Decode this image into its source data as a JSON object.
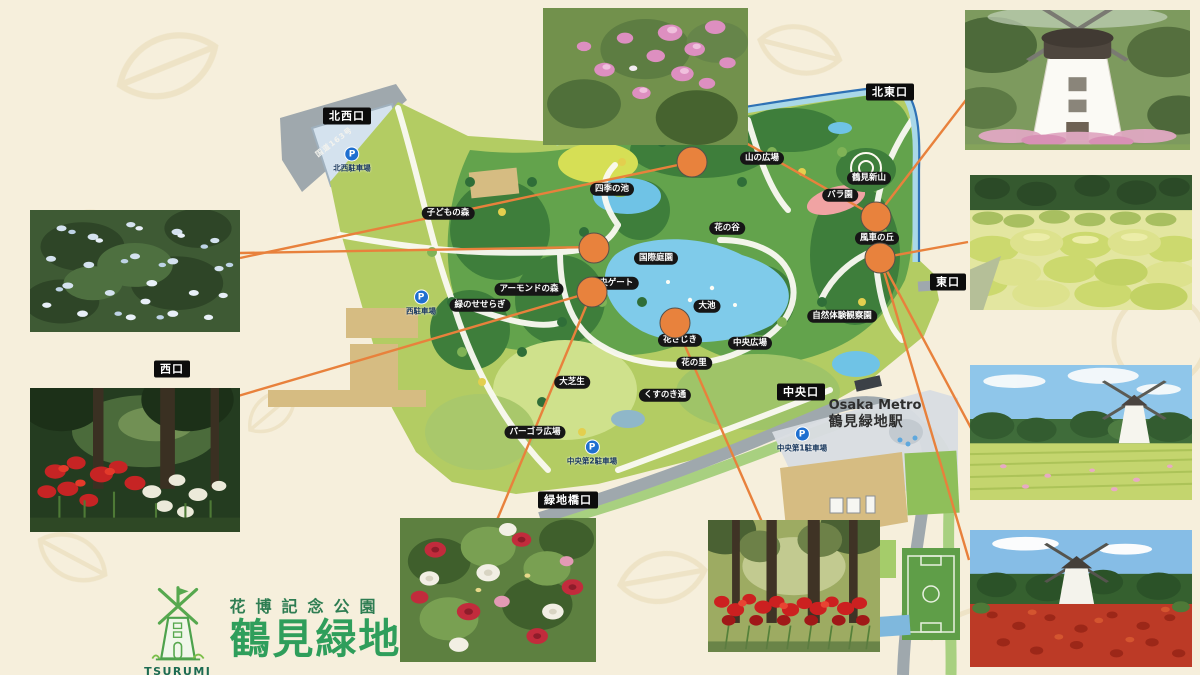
{
  "colors": {
    "background": "#f6efdc",
    "accent_orange": "#e8823d",
    "connector_orange": "#e8813c",
    "label_bg": "#141414",
    "park_green": "#b3cc63",
    "forest_green": "#3e7e3b",
    "pond_blue": "#7fcbea",
    "logo_green": "#2f9e5b",
    "parking_blue": "#1f6fd0"
  },
  "logo": {
    "park_type": "花博記念公園",
    "park_name": "鶴見緑地",
    "en_line1": "TSURUMI",
    "en_line2": "RYOKUCHI"
  },
  "station": {
    "brand": "Osaka Metro",
    "name": "鶴見緑地駅"
  },
  "map": {
    "road_label": "国道163号",
    "entrances": [
      {
        "id": "northwest",
        "label": "北西口",
        "x": 347,
        "y": 116
      },
      {
        "id": "northeast",
        "label": "北東口",
        "x": 890,
        "y": 92
      },
      {
        "id": "east",
        "label": "東口",
        "x": 948,
        "y": 282
      },
      {
        "id": "west",
        "label": "西口",
        "x": 172,
        "y": 369
      },
      {
        "id": "central",
        "label": "中央口",
        "x": 801,
        "y": 392
      },
      {
        "id": "ryokuchibashi",
        "label": "緑地橋口",
        "x": 568,
        "y": 500
      }
    ],
    "places": [
      {
        "label": "子どもの森",
        "x": 448,
        "y": 213
      },
      {
        "label": "アーモンドの森",
        "x": 529,
        "y": 289
      },
      {
        "label": "緑のせせらぎ",
        "x": 480,
        "y": 305
      },
      {
        "label": "四季の池",
        "x": 612,
        "y": 189
      },
      {
        "label": "山の広場",
        "x": 762,
        "y": 158
      },
      {
        "label": "花の谷",
        "x": 727,
        "y": 228
      },
      {
        "label": "国際庭園",
        "x": 656,
        "y": 258
      },
      {
        "label": "中央ゲート",
        "x": 612,
        "y": 283
      },
      {
        "label": "大池",
        "x": 707,
        "y": 306
      },
      {
        "label": "花さじき",
        "x": 680,
        "y": 340
      },
      {
        "label": "中央広場",
        "x": 750,
        "y": 343
      },
      {
        "label": "花の里",
        "x": 694,
        "y": 363
      },
      {
        "label": "大芝生",
        "x": 572,
        "y": 382
      },
      {
        "label": "くすのき通",
        "x": 665,
        "y": 395
      },
      {
        "label": "パーゴラ広場",
        "x": 535,
        "y": 432
      },
      {
        "label": "鶴見新山",
        "x": 869,
        "y": 178
      },
      {
        "label": "バラ園",
        "x": 840,
        "y": 195
      },
      {
        "label": "風車の丘",
        "x": 877,
        "y": 238
      },
      {
        "label": "自然体験観察園",
        "x": 842,
        "y": 316
      }
    ],
    "parkings": [
      {
        "label": "北西駐車場",
        "x": 352,
        "y": 160
      },
      {
        "label": "西駐車場",
        "x": 421,
        "y": 303
      },
      {
        "label": "中央第2駐車場",
        "x": 592,
        "y": 453
      },
      {
        "label": "中央第1駐車場",
        "x": 802,
        "y": 440
      }
    ],
    "markers": [
      {
        "x": 692,
        "y": 162
      },
      {
        "x": 594,
        "y": 248
      },
      {
        "x": 592,
        "y": 292
      },
      {
        "x": 675,
        "y": 323
      },
      {
        "x": 876,
        "y": 217
      },
      {
        "x": 880,
        "y": 258
      }
    ],
    "connectors": [
      {
        "x1": 240,
        "y1": 253,
        "x2": 596,
        "y2": 247
      },
      {
        "x1": 240,
        "y1": 258,
        "x2": 692,
        "y2": 162
      },
      {
        "x1": 238,
        "y1": 396,
        "x2": 592,
        "y2": 292
      },
      {
        "x1": 592,
        "y1": 292,
        "x2": 497,
        "y2": 520
      },
      {
        "x1": 675,
        "y1": 323,
        "x2": 762,
        "y2": 522
      },
      {
        "x1": 746,
        "y1": 143,
        "x2": 876,
        "y2": 217
      },
      {
        "x1": 966,
        "y1": 100,
        "x2": 876,
        "y2": 217
      },
      {
        "x1": 968,
        "y1": 242,
        "x2": 880,
        "y2": 258
      },
      {
        "x1": 880,
        "y1": 258,
        "x2": 971,
        "y2": 428
      },
      {
        "x1": 880,
        "y1": 258,
        "x2": 969,
        "y2": 560
      }
    ]
  },
  "photos": [
    {
      "id": "mukuge",
      "desc": "pink flowering shrub"
    },
    {
      "id": "windmill-closeup",
      "desc": "windmill close-up with pink grasses"
    },
    {
      "id": "kochia",
      "desc": "green kochia mounds garden"
    },
    {
      "id": "windmill-field",
      "desc": "windmill beside green flower field"
    },
    {
      "id": "windmill-red-field",
      "desc": "windmill above red flower field"
    },
    {
      "id": "spider-lily-trees",
      "desc": "red spider lilies under tree trunks"
    },
    {
      "id": "roses",
      "desc": "red and white roses"
    },
    {
      "id": "plumbago",
      "desc": "pale blue plumbago flowers"
    },
    {
      "id": "spider-lily-forest",
      "desc": "red and white spider lilies in forest"
    }
  ]
}
